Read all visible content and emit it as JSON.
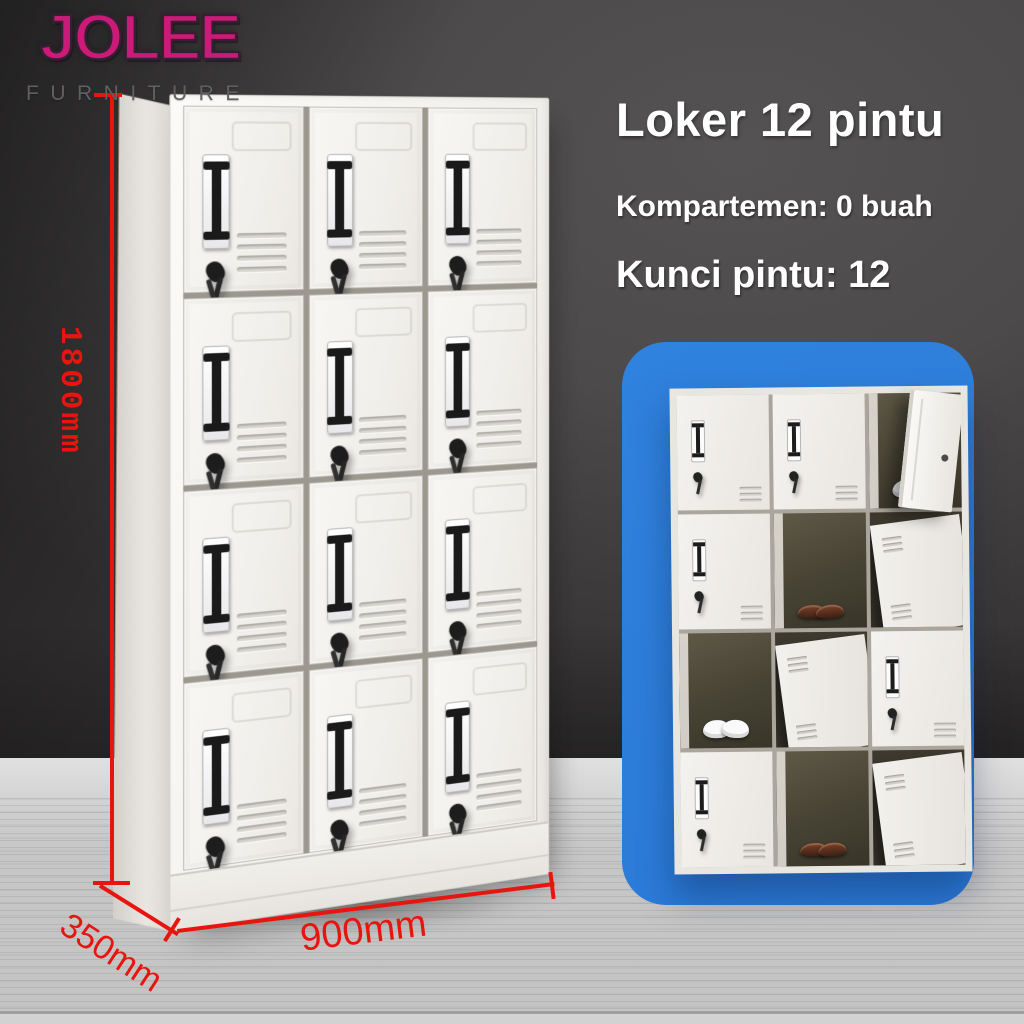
{
  "brand": {
    "name": "JOLEE",
    "subtitle": "FURNITURE"
  },
  "headline": {
    "title": "Loker 12 pintu",
    "spec_compartments": "Kompartemen: 0 buah",
    "spec_locks": "Kunci pintu: 12"
  },
  "dimensions": {
    "height": "1800mm",
    "depth": "350mm",
    "width": "900mm"
  },
  "main_locker": {
    "rows": 4,
    "columns": 3,
    "door_count": 12
  },
  "inset_locker": {
    "rows": 4,
    "columns": 3,
    "cells": [
      "closed",
      "closed",
      "open-sneakers",
      "closed",
      "open-loafers",
      "panel",
      "open-sneakers",
      "panel",
      "closed",
      "closed",
      "open-loafers",
      "panel"
    ]
  },
  "colors": {
    "accent_red": "#e8140e",
    "panel_blue": "#2b7dd9",
    "brand_magenta": "#cb1a78",
    "wall_gray": "#4c4a4a",
    "floor_gray": "#c6c6c6",
    "cabinet_white": "#f3f1ee"
  }
}
